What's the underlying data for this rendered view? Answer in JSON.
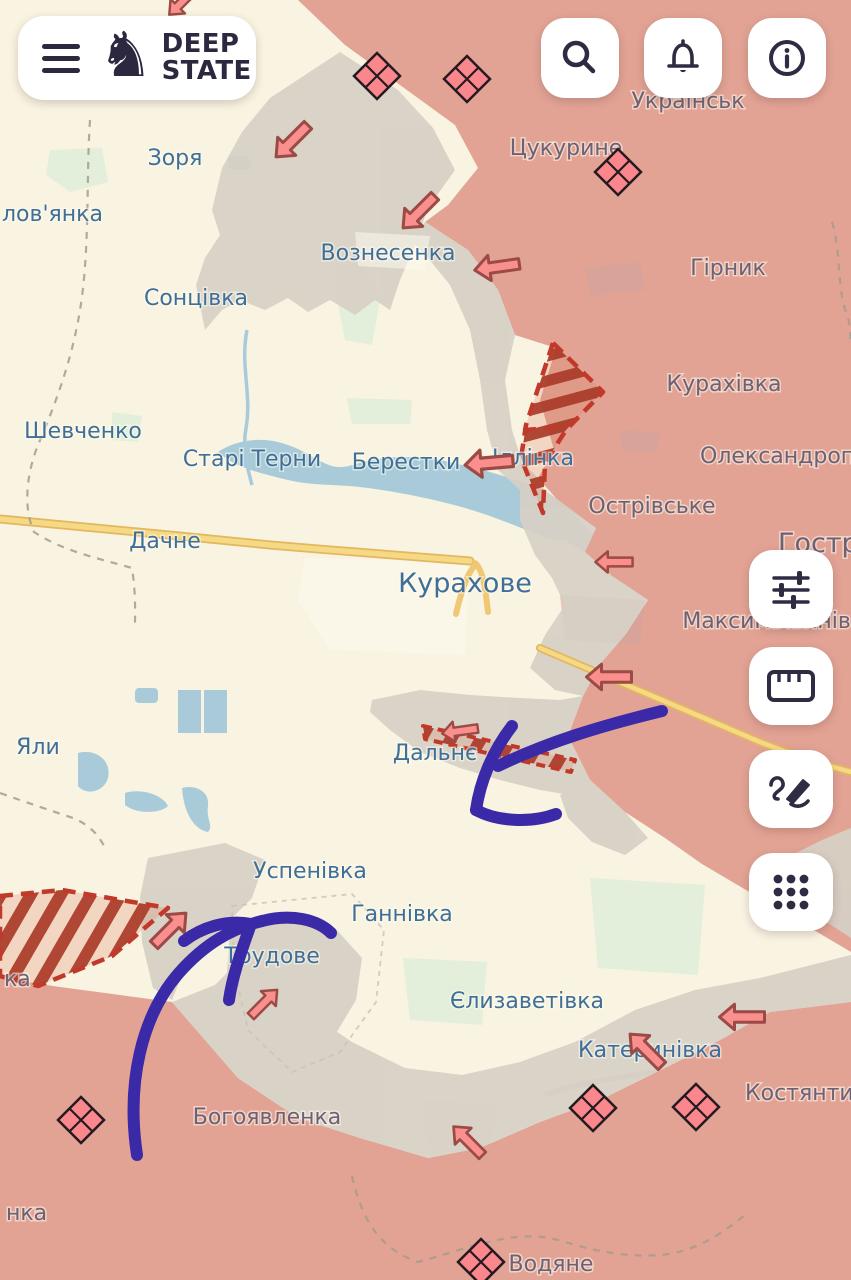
{
  "header": {
    "brand": {
      "line1": "DEEP",
      "line2": "STATE"
    },
    "menu": {
      "label": "menu"
    },
    "actions": [
      {
        "label": "search"
      },
      {
        "label": "notifications"
      },
      {
        "label": "info"
      }
    ]
  },
  "toolbar": {
    "items": [
      {
        "label": "filters"
      },
      {
        "label": "measure"
      },
      {
        "label": "draw"
      },
      {
        "label": "apps"
      }
    ]
  },
  "map": {
    "labels": [
      {
        "t": "Зоря",
        "type": "free-settlement"
      },
      {
        "t": "лов'янка",
        "type": "free-settlement"
      },
      {
        "t": "Українськ",
        "type": "occupied-settlement"
      },
      {
        "t": "Цукурине",
        "type": "occupied-settlement"
      },
      {
        "t": "Вознесенка",
        "type": "free-settlement"
      },
      {
        "t": "Сонцівка",
        "type": "free-settlement"
      },
      {
        "t": "Гірник",
        "type": "occupied-settlement"
      },
      {
        "t": "Курахівка",
        "type": "occupied-settlement"
      },
      {
        "t": "Шевченко",
        "type": "free-settlement"
      },
      {
        "t": "Старі Терни",
        "type": "free-settlement"
      },
      {
        "t": "Берестки",
        "type": "free-settlement"
      },
      {
        "t": "Іллінка",
        "type": "free-settlement"
      },
      {
        "t": "Олександропі",
        "type": "occupied-settlement"
      },
      {
        "t": "Острівське",
        "type": "occupied-settlement"
      },
      {
        "t": "Гостре",
        "type": "occupied-settlement"
      },
      {
        "t": "Дачне",
        "type": "free-settlement"
      },
      {
        "t": "Курахове",
        "type": "free-town"
      },
      {
        "t": "Максимільянівка",
        "type": "occupied-settlement"
      },
      {
        "t": "Яли",
        "type": "free-settlement"
      },
      {
        "t": "Дальнє",
        "type": "free-settlement"
      },
      {
        "t": "Успенівка",
        "type": "free-settlement"
      },
      {
        "t": "Ганнівка",
        "type": "free-settlement"
      },
      {
        "t": "Трудове",
        "type": "free-settlement"
      },
      {
        "t": "Єлизаветівка",
        "type": "free-settlement"
      },
      {
        "t": "Катеринівка",
        "type": "free-settlement"
      },
      {
        "t": "Костянти",
        "type": "occupied-settlement"
      },
      {
        "t": "Богоявленка",
        "type": "occupied-settlement"
      },
      {
        "t": "ка",
        "type": "occupied-settlement"
      },
      {
        "t": "нка",
        "type": "occupied-settlement"
      },
      {
        "t": "Водяне",
        "type": "occupied-settlement"
      }
    ],
    "clash_markers_count": 7,
    "attack_arrows_count": 13,
    "drawn_arrows_count": 2,
    "colors": {
      "occupied": "#e2a394",
      "contested": "#d7d0c5",
      "free": "#f9f3e1",
      "water": "#a9cbd9",
      "road": "#f0c873",
      "advance_hatch": "#c0392b",
      "clash_marker": "#f9878c",
      "attack_arrow": "#f9908d",
      "drawn_arrow": "#3b2aa8",
      "label_free": "#3f6f99",
      "label_occupied": "#6e6173",
      "ui_ink": "#2f2b43"
    }
  }
}
